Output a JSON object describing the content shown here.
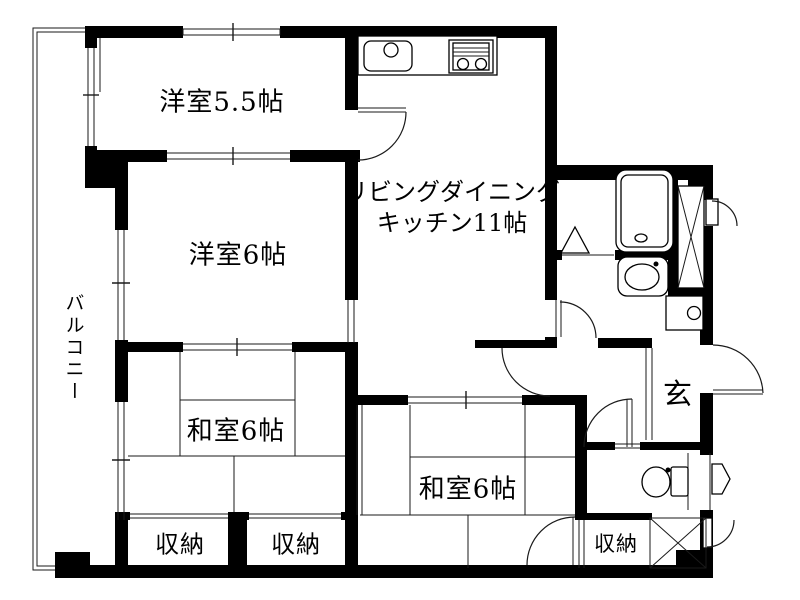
{
  "plan": {
    "title": "apartment-floor-plan",
    "rooms": {
      "western_room_5_5": {
        "label": "洋室5.5帖"
      },
      "western_room_6": {
        "label": "洋室6帖"
      },
      "ldk": {
        "label_line1": "リビングダイニング",
        "label_line2": "キッチン11帖"
      },
      "japanese_room_west": {
        "label": "和室6帖"
      },
      "japanese_room_center": {
        "label": "和室6帖"
      },
      "storage_west": {
        "label": "収納"
      },
      "storage_middle": {
        "label": "収納"
      },
      "storage_east": {
        "label": "収納"
      },
      "entrance": {
        "label": "玄"
      },
      "balcony": {
        "label": "バルコニー"
      }
    },
    "fixtures": [
      "kitchen-sink-icon",
      "gas-stove-icon",
      "bathtub-icon",
      "washbasin-icon",
      "washing-machine-pan-icon",
      "toilet-icon",
      "pipe-space-x-icon",
      "shaft-x-icon",
      "meter-box-pentagon-icon",
      "laundry-triangle-icon"
    ],
    "colors": {
      "wall": "#000000",
      "line": "#1a1a1a",
      "background": "#ffffff"
    }
  }
}
